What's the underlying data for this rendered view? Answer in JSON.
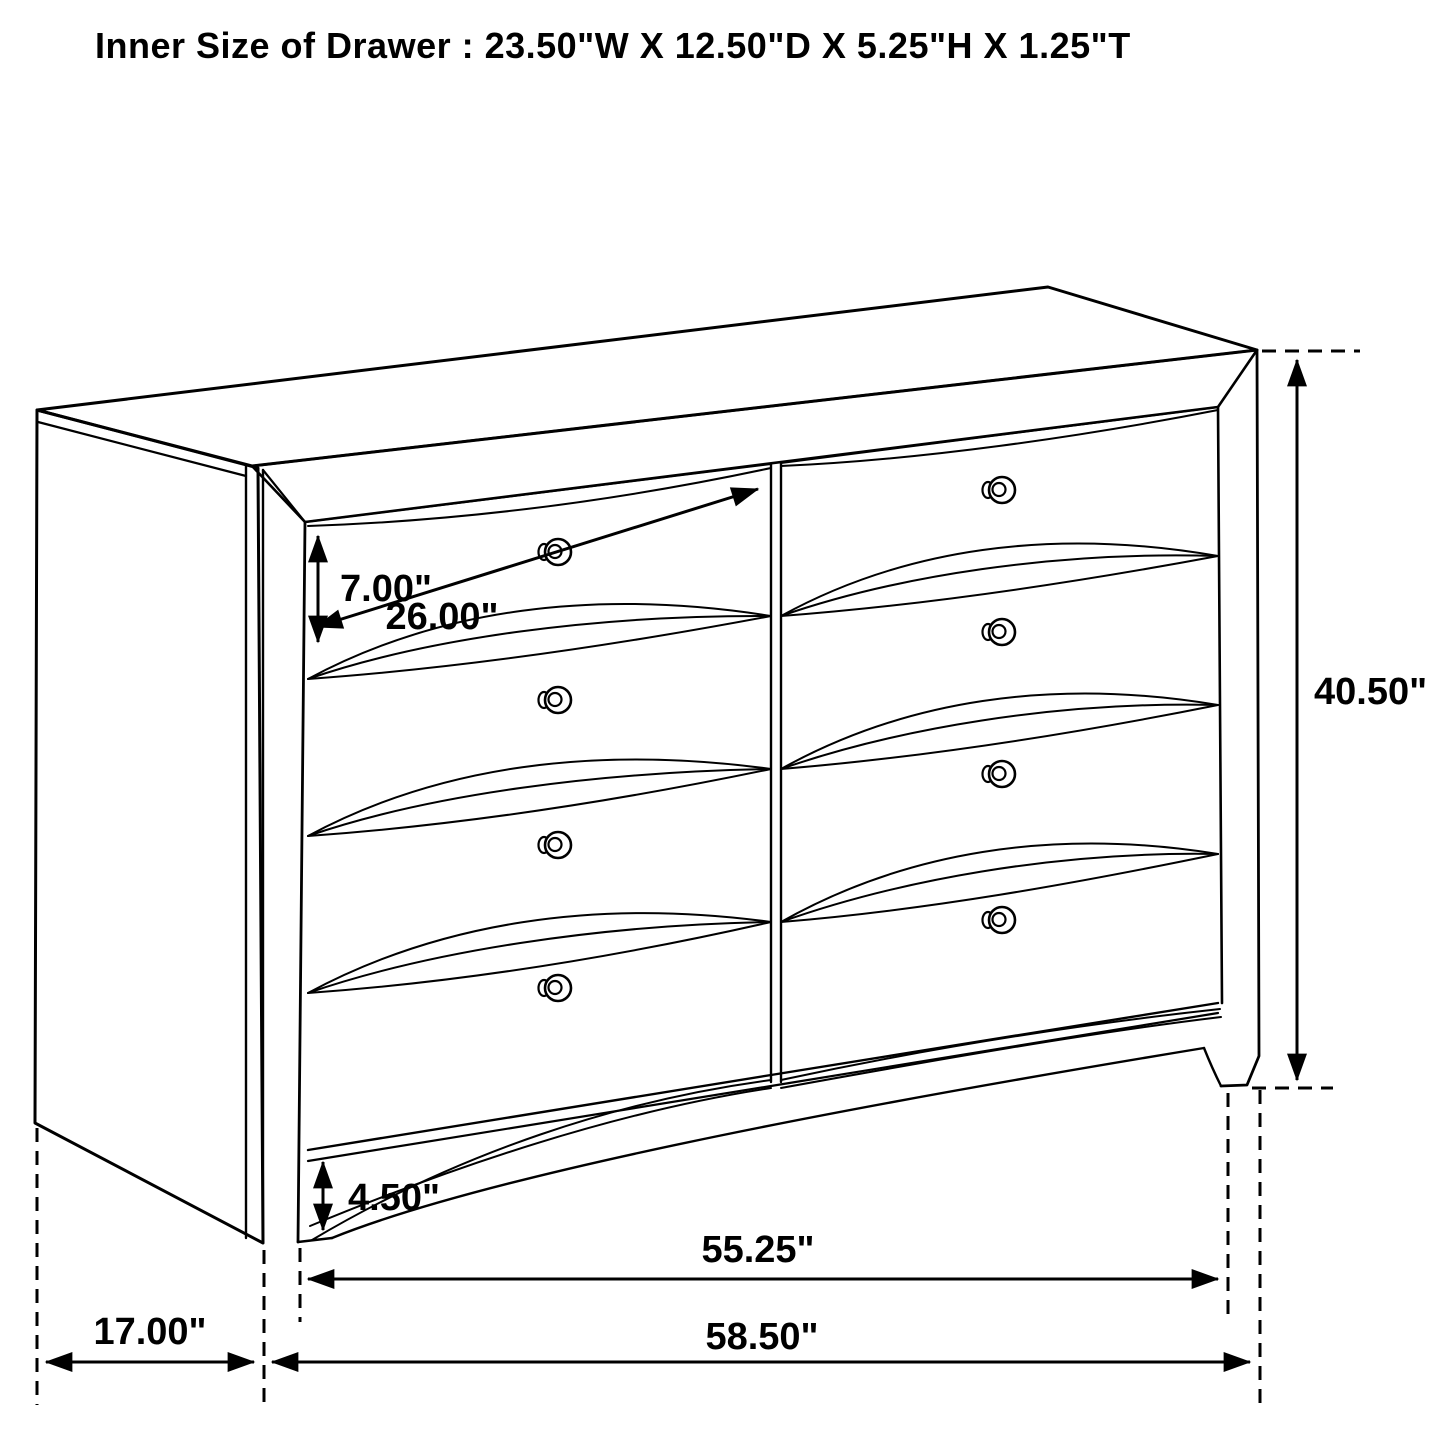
{
  "page": {
    "background": "#ffffff",
    "ink_color": "#000000"
  },
  "title": "Inner Size of Drawer : 23.50\"W X 12.50\"D X 5.25\"H X 1.25\"T",
  "diagram": {
    "type": "furniture-dimension-line-drawing",
    "item": "six-drawer dresser shown in 3D perspective with dimension arrows",
    "dimensions": {
      "drawer_front_height": "7.00\"",
      "drawer_front_width": "26.00\"",
      "overall_height": "40.50\"",
      "base_height": "4.50\"",
      "front_width_between_feet": "55.25\"",
      "overall_width": "58.50\"",
      "side_depth": "17.00\"",
      "inner_drawer_width": "23.50\"",
      "inner_drawer_depth": "12.50\"",
      "inner_drawer_height": "5.25\"",
      "inner_drawer_thickness": "1.25\""
    }
  }
}
